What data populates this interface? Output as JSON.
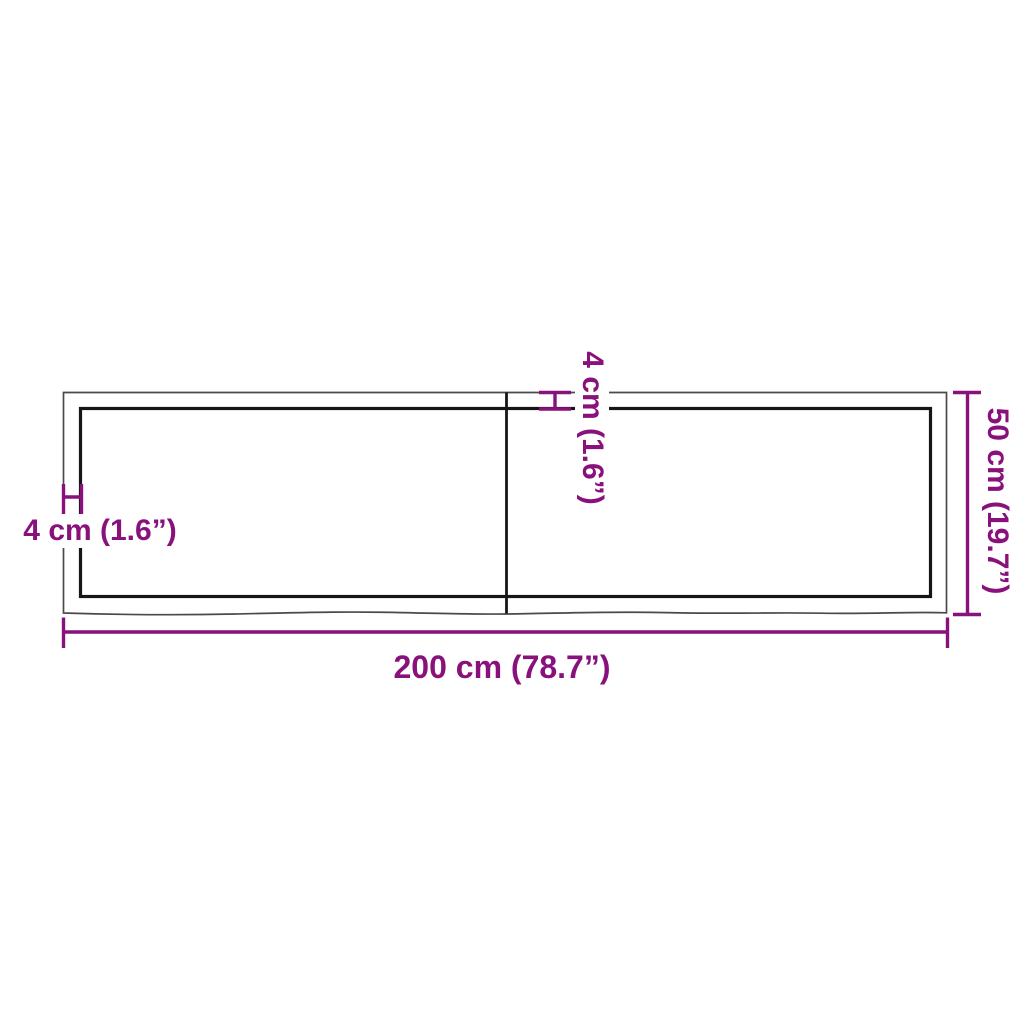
{
  "diagram": {
    "description": "Wooden table top / shelf panel dimension drawing with live edge, two-board top",
    "dimensions": {
      "length": "200 cm (78.7”)",
      "depth": "50 cm (19.7”)",
      "thickness_left": "4 cm (1.6”)",
      "thickness_center": "4 cm (1.6”)"
    },
    "colors": {
      "dimension_accent": "#89117C",
      "outer_edge": "#4A4A4A",
      "inner_edge": "#161616",
      "background": "#FFFFFF"
    }
  }
}
